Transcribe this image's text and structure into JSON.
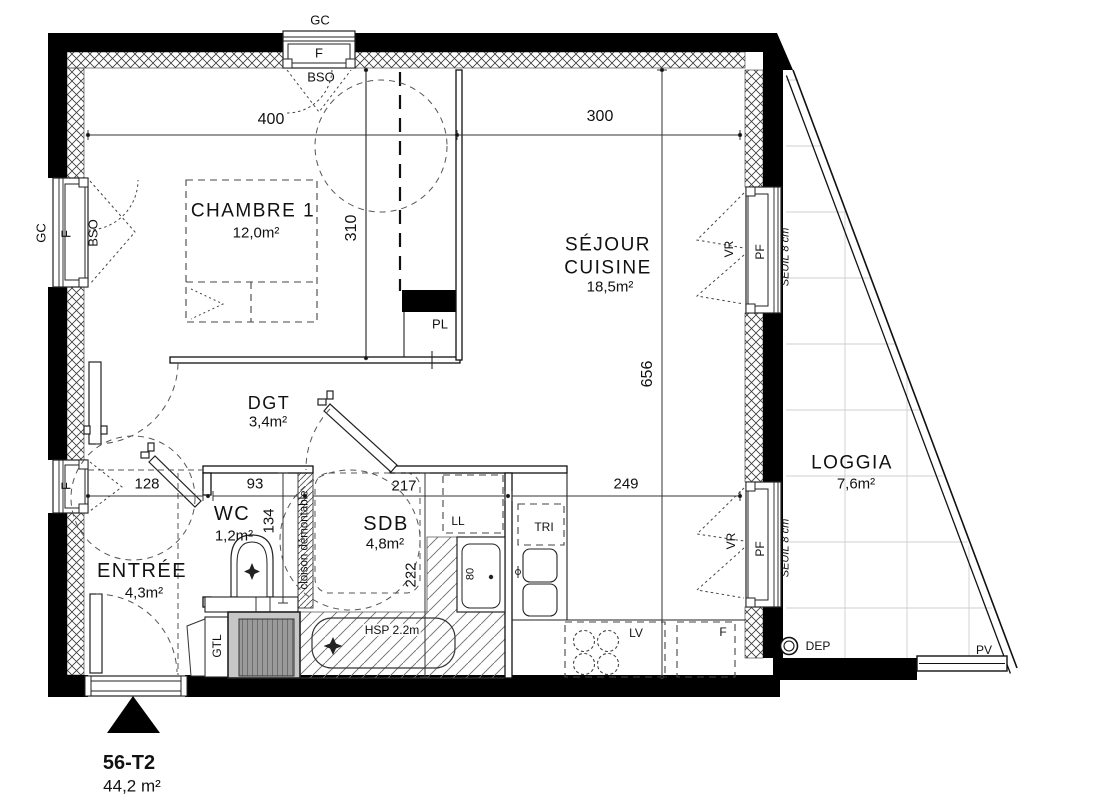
{
  "plan": {
    "unit_title": "56-T2",
    "unit_area": "44,2 m²",
    "rooms": {
      "chambre": {
        "name": "CHAMBRE 1",
        "area": "12,0m²"
      },
      "sejour": {
        "name_line1": "SÉJOUR",
        "name_line2": "CUISINE",
        "area": "18,5m²"
      },
      "dgt": {
        "name": "DGT",
        "area": "3,4m²"
      },
      "wc": {
        "name": "WC",
        "area": "1,2m²"
      },
      "sdb": {
        "name": "SDB",
        "area": "4,8m²"
      },
      "entree": {
        "name": "ENTRÉE",
        "area": "4,3m²"
      },
      "loggia": {
        "name": "LOGGIA",
        "area": "7,6m²"
      }
    },
    "dimensions": {
      "top_left": "400",
      "top_right": "300",
      "chambre_depth": "310",
      "sejour_depth": "656",
      "entree_width": "128",
      "wc_width": "93",
      "sdb_width": "217",
      "cuisine_width": "249",
      "wc_depth": "134",
      "sdb_depth": "222",
      "shower_width": "80"
    },
    "windows": {
      "top": {
        "gc": "GC",
        "f": "F",
        "bso": "BSO"
      },
      "left1": {
        "gc": "GC",
        "f": "F",
        "bso": "BSO"
      },
      "left2": {
        "f": "F"
      },
      "right1": {
        "vr": "VR",
        "pf": "PF",
        "seuil": "SEUIL 8 cm"
      },
      "right2": {
        "vr": "VR",
        "pf": "PF",
        "seuil": "SEUIL 8 cm"
      }
    },
    "annotations": {
      "pl": "PL",
      "ll": "LL",
      "tri": "TRI",
      "lv": "LV",
      "fridge": "F",
      "gtl": "GTL",
      "dep": "DEP",
      "pv": "PV",
      "hsp": "HSP 2.2m",
      "cloison": "cloison démontable"
    }
  }
}
